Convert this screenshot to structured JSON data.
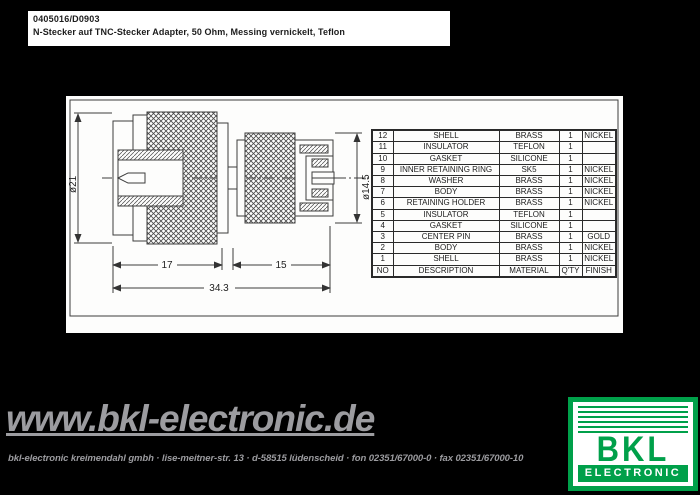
{
  "header": {
    "part_number": "0405016/D0903",
    "description": "N-Stecker auf TNC-Stecker Adapter, 50 Ohm, Messing vernickelt, Teflon"
  },
  "drawing": {
    "dia_left": "ø21",
    "dia_right": "ø14.5",
    "len_left": "17",
    "len_right": "15",
    "len_total": "34.3"
  },
  "parts_table": {
    "columns": [
      "NO",
      "DESCRIPTION",
      "MATERIAL",
      "Q'TY",
      "FINISH"
    ],
    "rows": [
      {
        "no": "12",
        "description": "SHELL",
        "material": "BRASS",
        "qty": "1",
        "finish": "NICKEL"
      },
      {
        "no": "11",
        "description": "INSULATOR",
        "material": "TEFLON",
        "qty": "1",
        "finish": ""
      },
      {
        "no": "10",
        "description": "GASKET",
        "material": "SILICONE",
        "qty": "1",
        "finish": ""
      },
      {
        "no": "9",
        "description": "INNER RETAINING RING",
        "material": "SK5",
        "qty": "1",
        "finish": "NICKEL"
      },
      {
        "no": "8",
        "description": "WASHER",
        "material": "BRASS",
        "qty": "1",
        "finish": "NICKEL"
      },
      {
        "no": "7",
        "description": "BODY",
        "material": "BRASS",
        "qty": "1",
        "finish": "NICKEL"
      },
      {
        "no": "6",
        "description": "RETAINING HOLDER",
        "material": "BRASS",
        "qty": "1",
        "finish": "NICKEL"
      },
      {
        "no": "5",
        "description": "INSULATOR",
        "material": "TEFLON",
        "qty": "1",
        "finish": ""
      },
      {
        "no": "4",
        "description": "GASKET",
        "material": "SILICONE",
        "qty": "1",
        "finish": ""
      },
      {
        "no": "3",
        "description": "CENTER PIN",
        "material": "BRASS",
        "qty": "1",
        "finish": "GOLD"
      },
      {
        "no": "2",
        "description": "BODY",
        "material": "BRASS",
        "qty": "1",
        "finish": "NICKEL"
      },
      {
        "no": "1",
        "description": "SHELL",
        "material": "BRASS",
        "qty": "1",
        "finish": "NICKEL"
      }
    ]
  },
  "footer": {
    "website": "www.bkl-electronic.de",
    "address": "bkl-electronic kreimendahl gmbh · lise-meitner-str. 13 · d-58515 lüdenscheid · fon 02351/67000-0 · fax 02351/67000-10",
    "logo": {
      "brand": "BKL",
      "subtitle": "ELECTRONIC"
    }
  },
  "colors": {
    "brand_green": "#00a04a",
    "footer_gray": "#9c9ca0"
  }
}
